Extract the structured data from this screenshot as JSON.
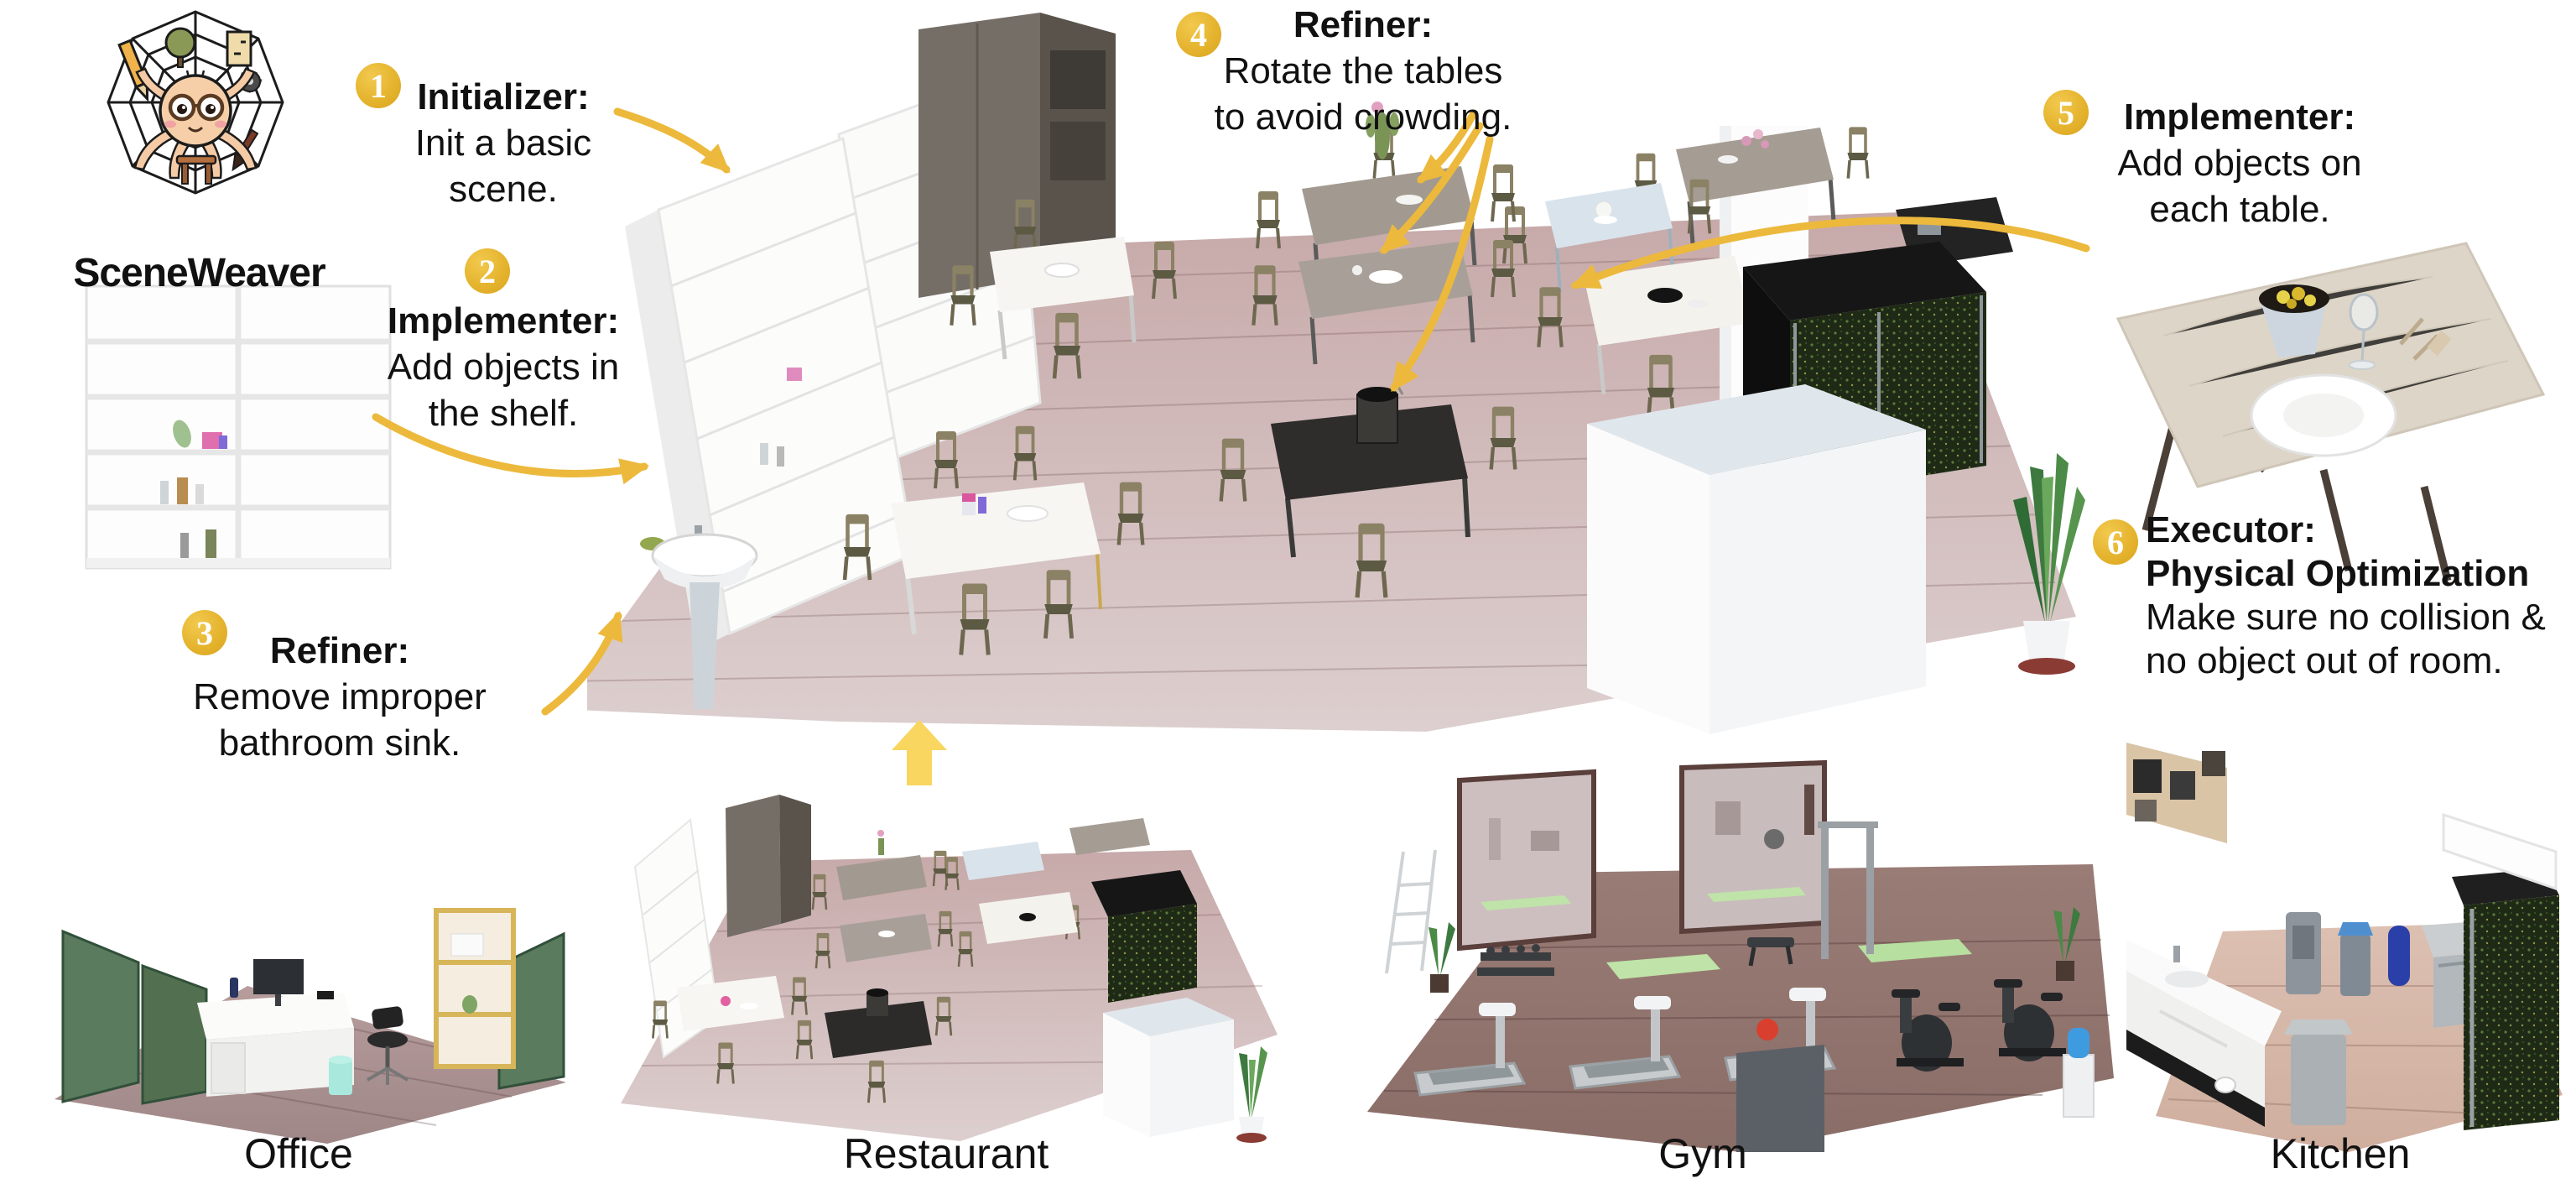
{
  "figure": {
    "logo_title": "SceneWeaver",
    "steps": [
      {
        "num": "1",
        "title": "Initializer:",
        "lines": [
          "Init a basic",
          "scene."
        ]
      },
      {
        "num": "2",
        "title": "Implementer:",
        "lines": [
          "Add objects in",
          "the shelf."
        ]
      },
      {
        "num": "3",
        "title": "Refiner:",
        "lines": [
          "Remove improper",
          "bathroom sink."
        ]
      },
      {
        "num": "4",
        "title": "Refiner:",
        "lines": [
          "Rotate the tables",
          "to avoid crowding."
        ]
      },
      {
        "num": "5",
        "title": "Implementer:",
        "lines": [
          "Add objects on",
          "each table."
        ]
      },
      {
        "num": "6",
        "title": "Executor:",
        "subtitle": "Physical Optimization",
        "lines": [
          "Make sure no collision &",
          "no object out of room."
        ]
      }
    ],
    "scene_labels": [
      "Office",
      "Restaurant",
      "Gym",
      "Kitchen"
    ]
  },
  "colors": {
    "badge_gold": "#E4B22C",
    "arrow_gold": "#ECB93C",
    "block_arrow_yellow": "#F8D65F",
    "main_floor": "#CFB5B5",
    "office_floor": "#AC9292",
    "gym_floor": "#967A74",
    "kitchen_floor": "#D8BCAE"
  },
  "illustrations": {
    "logo_icon": "spider-web-mascot",
    "main_scene": "restaurant-room-render",
    "shelf_inset": "white-bookshelf-render",
    "table_inset": "dining-table-render",
    "flow_arrow": "up-block-arrow",
    "bottom_scenes": [
      "office-room-render",
      "restaurant-room-render",
      "gym-room-render",
      "kitchen-room-render"
    ]
  }
}
